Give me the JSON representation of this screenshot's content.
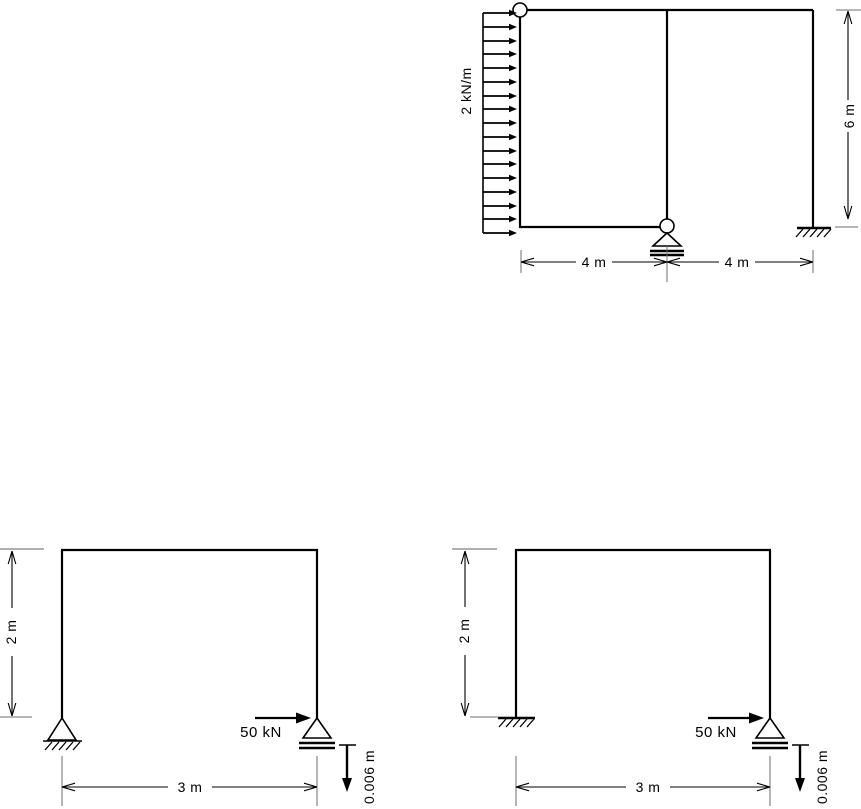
{
  "figures": {
    "figure_top": {
      "load_label": "2 kN/m",
      "dim_bay_left": "4 m",
      "dim_bay_right": "4 m",
      "dim_height": "6 m"
    },
    "figure_bottom_left": {
      "force_label": "50 kN",
      "settlement_label": "0.006 m",
      "dim_height": "2 m",
      "dim_span": "3 m"
    },
    "figure_bottom_right": {
      "force_label": "50 kN",
      "settlement_label": "0.006 m",
      "dim_height": "2 m",
      "dim_span": "3 m"
    }
  },
  "colors": {
    "line": "#000000",
    "extension_tick": "#6e6e6e",
    "light_tick": "#b0b0b0",
    "background": "#ffffff"
  }
}
